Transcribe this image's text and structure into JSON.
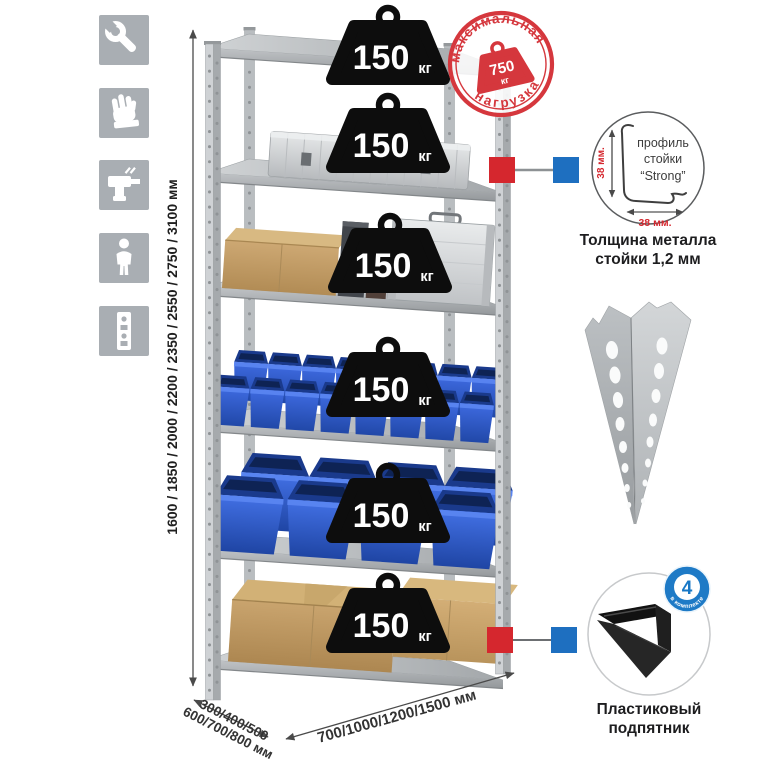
{
  "sidebar_icons": [
    {
      "icon": "wrench-icon"
    },
    {
      "icon": "gloves-icon"
    },
    {
      "icon": "drill-icon"
    },
    {
      "icon": "person-icon"
    },
    {
      "icon": "rack-post-icon"
    }
  ],
  "dimensions": {
    "height": "1600 / 1850 / 2000 / 2200 / 2350 / 2550 / 2750 / 3100 мм",
    "depth_line1": "300/400/500",
    "depth_line2": "600/700/800 мм",
    "width": "700/1000/1200/1500 мм"
  },
  "rack": {
    "shelf_count": 6,
    "load_badge": {
      "value": "150",
      "unit": "кг"
    }
  },
  "stamp": {
    "arc_top": "максимальная",
    "arc_bottom": "нагрузка",
    "value": "750",
    "unit": "кг"
  },
  "profile_detail": {
    "line1": "профиль",
    "line2": "стойки",
    "line3": "“Strong”",
    "dim_vertical": "38 мм.",
    "dim_horizontal": "38 мм.",
    "caption_line1": "Толщина металла",
    "caption_line2": "стойки 1,2 мм"
  },
  "foot_detail": {
    "badge_value": "4",
    "badge_arc_text": "в комплекте",
    "caption_line1": "Пластиковый",
    "caption_line2": "подпятник"
  },
  "colors": {
    "accent_red": "#d5373d",
    "marker_red": "#d5272e",
    "marker_blue": "#1e6fc0",
    "badge_blue": "#1e7ac6",
    "bin_blue": "#2b59cf",
    "steel": "#b4b8bb",
    "cardboard": "#c3a06a",
    "badge_black": "#0d0d0d"
  }
}
